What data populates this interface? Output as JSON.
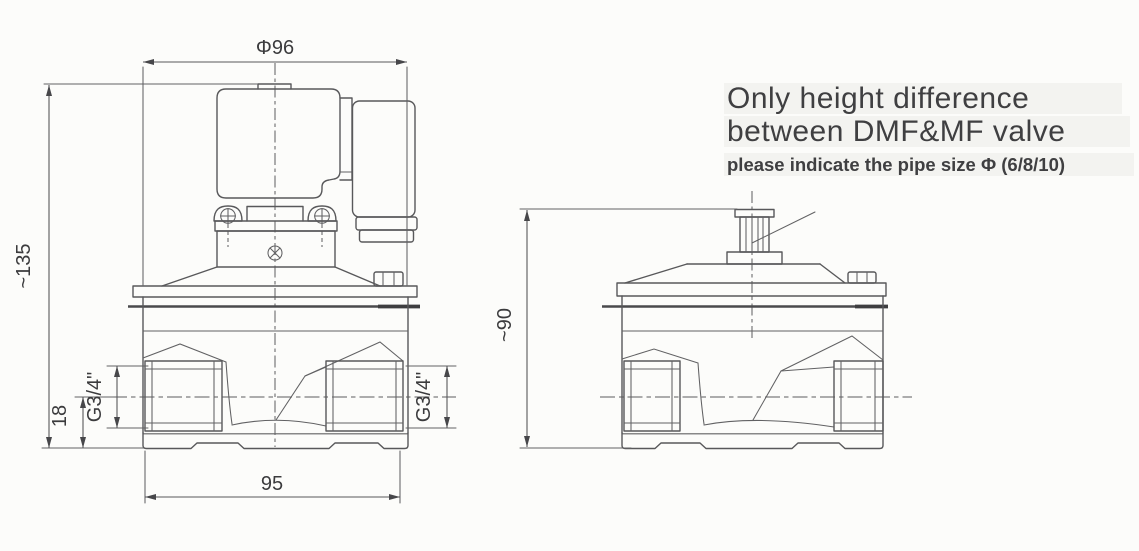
{
  "note": {
    "line1": "Only height difference",
    "line2": "between DMF&MF valve",
    "line3": "please indicate the pipe size Φ (6/8/10)"
  },
  "front_view": {
    "dims": {
      "diameter": "Φ96",
      "height": "~135",
      "port_axis": "18",
      "port_left": "G3/4\"",
      "port_right": "G3/4\"",
      "width": "95"
    }
  },
  "side_view": {
    "dims": {
      "height": "~90"
    }
  },
  "colors": {
    "line": "#58585a",
    "text": "#3f3f41",
    "background": "#fcfcfa"
  }
}
